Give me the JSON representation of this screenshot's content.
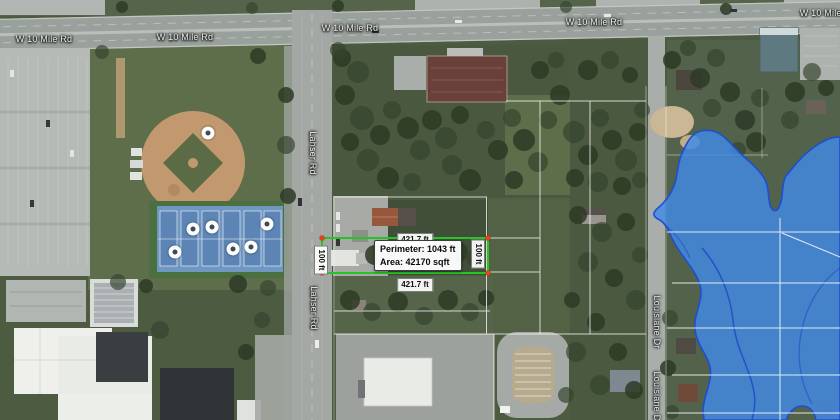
{
  "app": {
    "type": "aerial-map-measurement-view"
  },
  "roads": {
    "w10mile": "W 10 Mile Rd",
    "lahser": "Lahser Rd",
    "louisiane": "Louisiane Dr"
  },
  "measurement": {
    "perimeter": "Perimeter: 1043 ft",
    "area": "Area: 42170 sqft",
    "width_top": "421.7 ft",
    "width_bottom": "421.7 ft",
    "height_left": "100 ft",
    "height_right": "100 ft"
  },
  "icons": {
    "poi_marker": "white-circle-with-dark-dot"
  },
  "colors": {
    "measure_line": "#25c525",
    "vertex": "#e8401c",
    "water_fill": "#418ae6",
    "water_edge": "#1d4fd2"
  }
}
